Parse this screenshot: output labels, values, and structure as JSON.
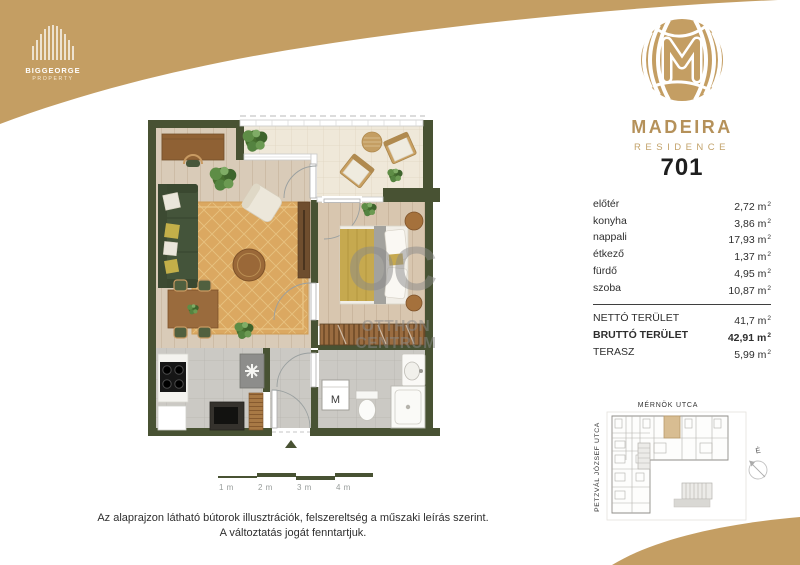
{
  "brand": {
    "developer": {
      "name": "BIGGEORGE",
      "subtitle": "PROPERTY"
    },
    "project": {
      "name": "MADEIRA",
      "subtitle": "RESIDENCE"
    }
  },
  "unit": {
    "number": "701",
    "area_unit": "m",
    "area_sup": "2",
    "rooms": [
      {
        "label": "előtér",
        "value": "2,72"
      },
      {
        "label": "konyha",
        "value": "3,86"
      },
      {
        "label": "nappali",
        "value": "17,93"
      },
      {
        "label": "étkező",
        "value": "1,37"
      },
      {
        "label": "fürdő",
        "value": "4,95"
      },
      {
        "label": "szoba",
        "value": "10,87"
      }
    ],
    "totals": [
      {
        "label": "NETTÓ TERÜLET",
        "value": "41,7"
      },
      {
        "label": "BRUTTÓ TERÜLET",
        "value": "42,91"
      },
      {
        "label": "TERASZ",
        "value": "5,99"
      }
    ]
  },
  "floorplan": {
    "washing_machine_label": "M",
    "watermark": {
      "initials": "OC",
      "line1": "OTTHON",
      "line2": "CENTRUM"
    },
    "scale_labels": [
      "1 m",
      "2 m",
      "3 m",
      "4 m"
    ]
  },
  "siteplan": {
    "street_top": "MÉRNÖK UTCA",
    "street_left": "PETZVÁL JÓZSEF UTCA",
    "compass_label": "É"
  },
  "disclaimer": {
    "line1": "Az alaprajzon látható bútorok illusztrációk, felszereltség a műszaki leírás szerint.",
    "line2": "A változtatás jogát fenntartjuk."
  },
  "colors": {
    "brand_gold": "#C49E63",
    "wall_green": "#485233",
    "highlight_tan": "#D8BD92",
    "rug_gold": "#DBA861",
    "duvet_yellow": "#C6A94F"
  }
}
